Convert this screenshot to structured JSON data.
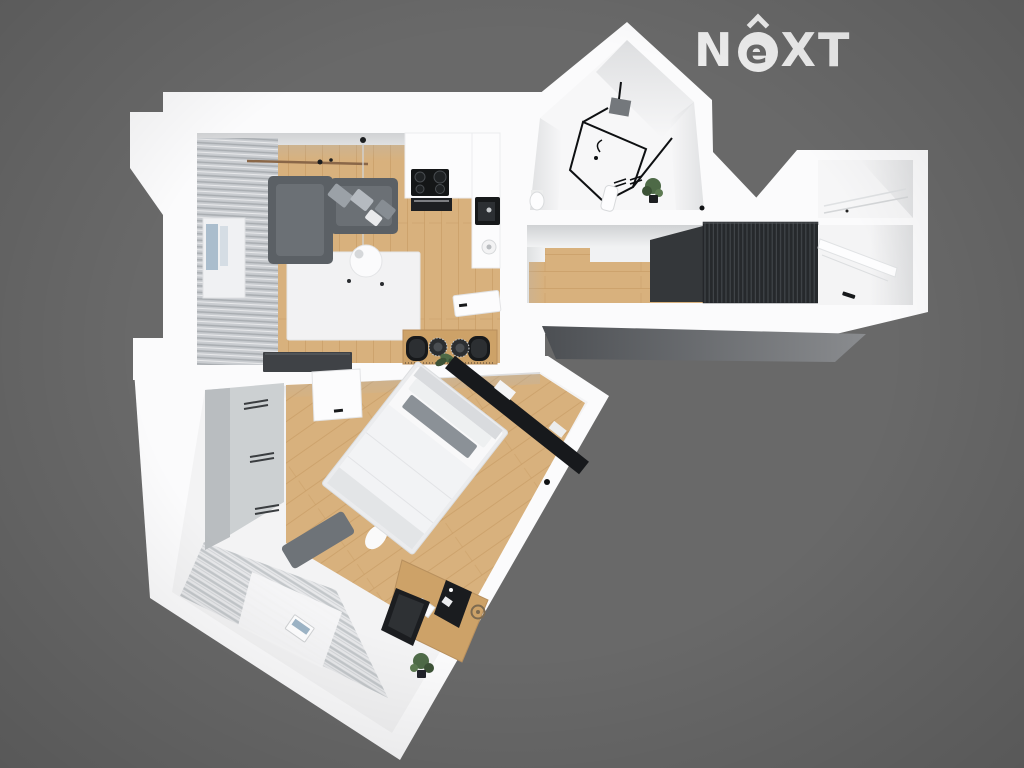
{
  "logo": {
    "n": "N",
    "e": "e",
    "xt": "XT"
  },
  "palette": {
    "bg": "#696969",
    "logo": "#ededed",
    "wall": "#fbfbfc",
    "floorLight": "#f3f3f4",
    "wood": "#d8b17d",
    "wood2": "#cda268",
    "plank": "#bf9257",
    "rugWhite": "#f2f2f3",
    "curtain": "#c9ccd0",
    "curtainStripe": "#9ea2a6",
    "sofa": "#5b6065",
    "sofaLight": "#6b7075",
    "pillowGray": "#9ba1a7",
    "darkPanel": "#17191c",
    "slat": "#26292c",
    "slatLine": "#43474b",
    "black": "#17191b",
    "bench": "#6e7378",
    "wardrobe": "#ccd0d2",
    "wardrobeSide": "#b9bdc0",
    "rugStripe": "#c3c7ca",
    "rugBase": "#e7e8ea",
    "plant": "#4e6a47",
    "plantDark": "#3c5236",
    "shadowFaceDark": "#4c4f53",
    "shadowFaceLight": "#8a8c8f",
    "glassBlue": "#9db4c6"
  }
}
